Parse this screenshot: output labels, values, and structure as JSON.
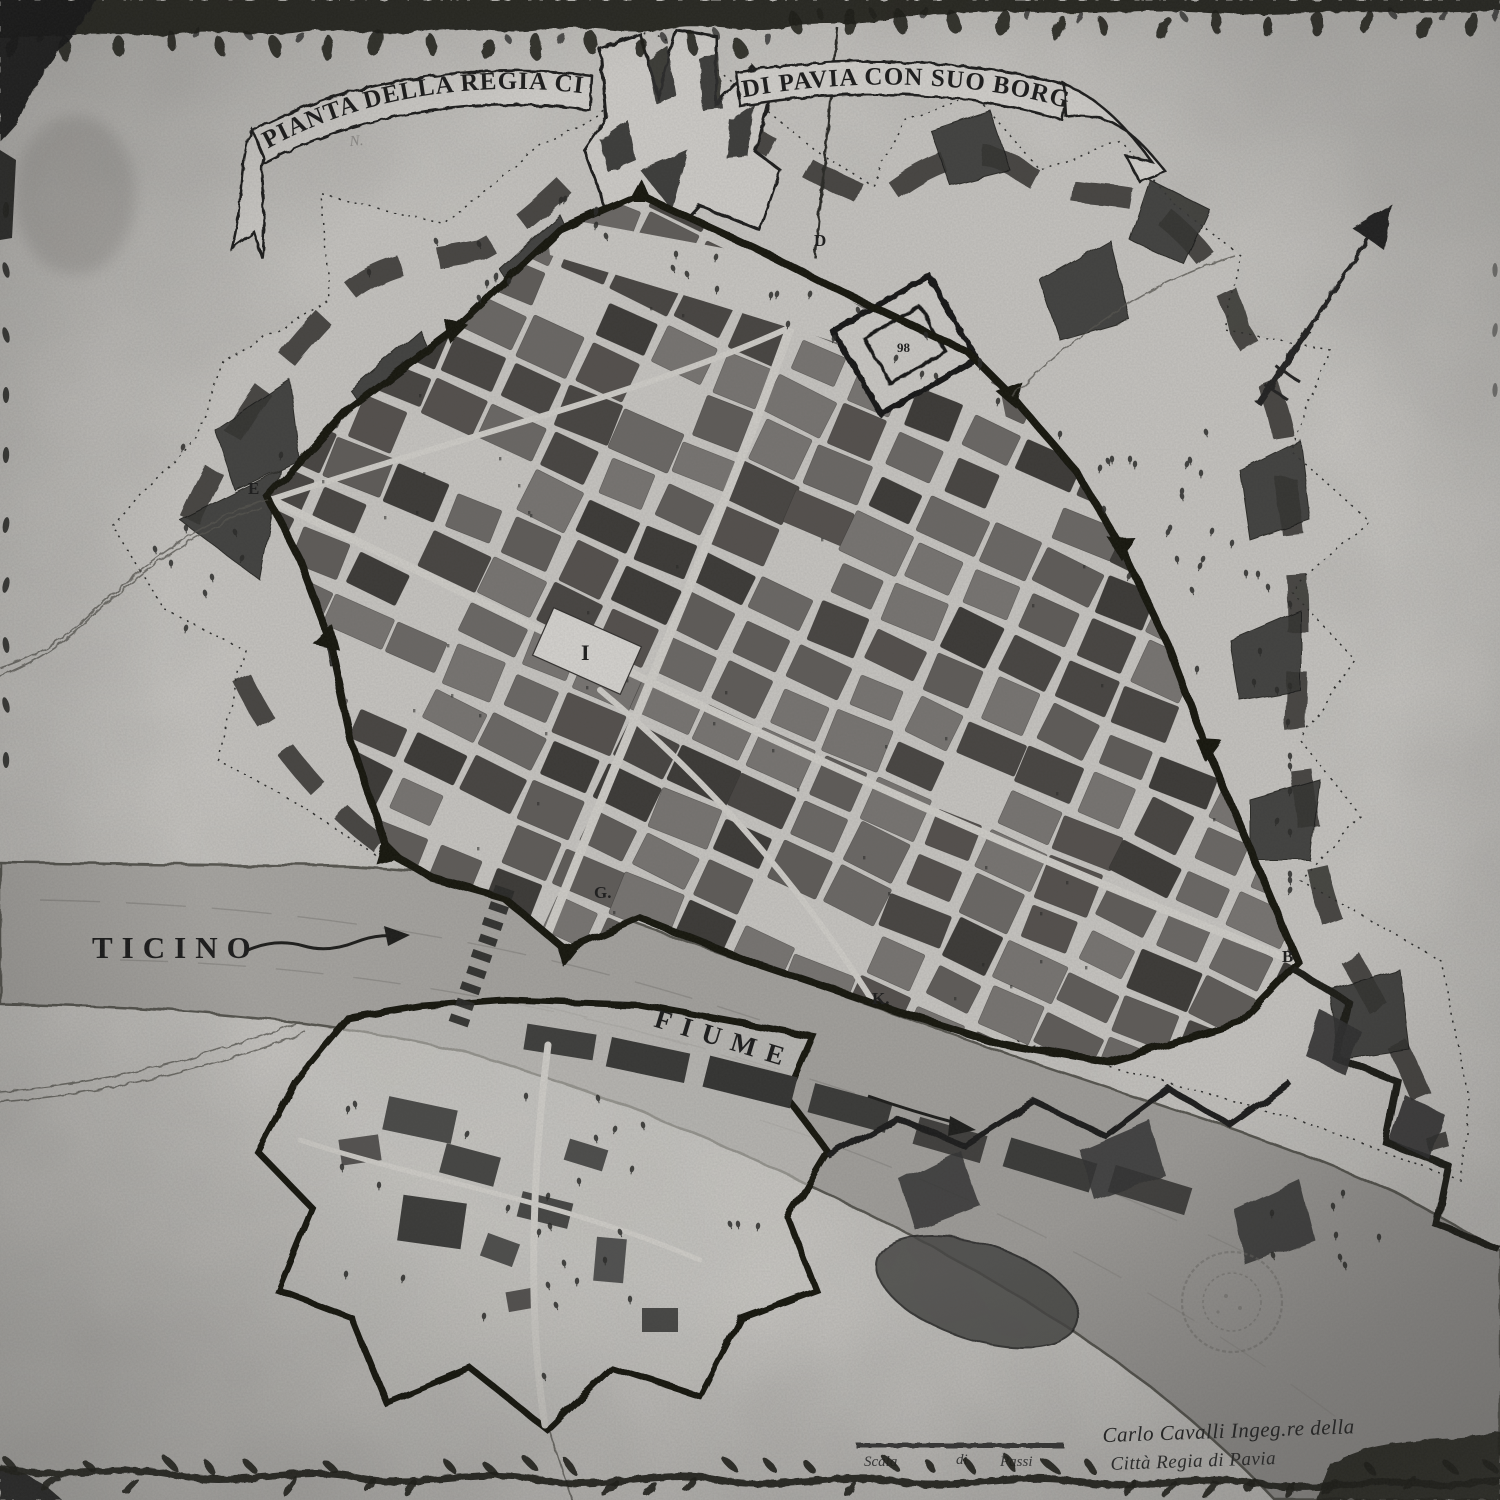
{
  "banner": {
    "left_text": "PIANTA DELLA REGIA CITTA'",
    "right_text": "DI PAVIA CON SUO BORGO"
  },
  "labels": {
    "river_name": "TICINO",
    "river_word": "FIUME"
  },
  "gates": {
    "e": "E",
    "d": "D",
    "g": "G.",
    "k": "K.",
    "b": "B"
  },
  "map_marks": {
    "plaza_numeral": "I",
    "castle_number": "98",
    "pencil_note": "N."
  },
  "scale": {
    "word1": "Scala",
    "word2": "di",
    "word3": "Passi"
  },
  "signature": {
    "line1": "Carlo Cavalli Ingeg.re della",
    "line2": "Città Regia di Pavia"
  },
  "icons": {
    "north_arrow": "north-arrow",
    "stamp": "circular-archive-stamp",
    "border_ornament": "leaf-vine-border",
    "flow_arrow": "river-flow-arrow"
  },
  "colors": {
    "paper": "#cac8c4",
    "ink": "#1c1c1c",
    "river": "#a6a4a0",
    "blocks": "#4c4c4c"
  }
}
